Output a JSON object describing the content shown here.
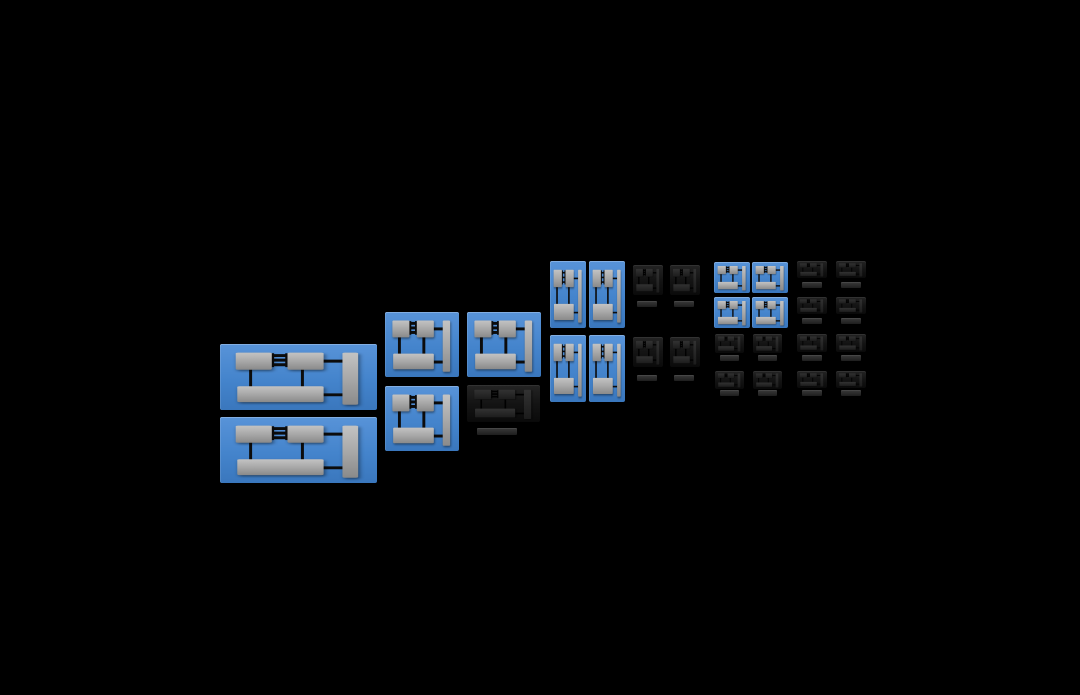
{
  "scene": {
    "width": 1080,
    "height": 695,
    "kind": "zoomable-canvas",
    "tile_icon": "block-diagram-icon",
    "tile_variants": [
      "blue",
      "dark"
    ]
  },
  "palette": {
    "background": "#000000",
    "tile_highlight_top": "#5893d8",
    "tile_highlight_mid": "#4484cc",
    "tile_highlight_bottom": "#3a77bd",
    "tile_faded_top": "#242424",
    "tile_faded_mid": "#141414",
    "tile_faded_bottom": "#0a0a0a",
    "block_gray_top": "#c3c3c3",
    "block_gray_mid": "#a8a8a8",
    "block_gray_bottom": "#8a8a8a",
    "block_dark_top": "#323232",
    "block_dark_bottom": "#1c1c1c",
    "wire_color": "#0c0c0c",
    "label_bar_top": "#3a3a3a",
    "label_bar_bottom": "#1e1e1e"
  },
  "tiles": [
    {
      "id": "large-1",
      "variant": "blue",
      "x": 220,
      "y": 344,
      "w": 157,
      "h": 66
    },
    {
      "id": "large-2",
      "variant": "blue",
      "x": 220,
      "y": 417,
      "w": 157,
      "h": 66
    },
    {
      "id": "medium-1",
      "variant": "blue",
      "x": 385,
      "y": 312,
      "w": 74,
      "h": 65
    },
    {
      "id": "medium-2",
      "variant": "blue",
      "x": 467,
      "y": 312,
      "w": 74,
      "h": 65
    },
    {
      "id": "medium-3",
      "variant": "blue",
      "x": 385,
      "y": 386,
      "w": 74,
      "h": 65
    },
    {
      "id": "medium-faded",
      "variant": "dark",
      "x": 467,
      "y": 385,
      "w": 73,
      "h": 37,
      "label_bar": {
        "x": 477,
        "y": 428,
        "w": 40,
        "h": 7
      }
    },
    {
      "id": "tall-1",
      "variant": "blue",
      "x": 550,
      "y": 261,
      "w": 36,
      "h": 67
    },
    {
      "id": "tall-2",
      "variant": "blue",
      "x": 589,
      "y": 261,
      "w": 36,
      "h": 67
    },
    {
      "id": "tall-3",
      "variant": "blue",
      "x": 550,
      "y": 335,
      "w": 36,
      "h": 67
    },
    {
      "id": "tall-4",
      "variant": "blue",
      "x": 589,
      "y": 335,
      "w": 36,
      "h": 67
    },
    {
      "id": "square-faded-1",
      "variant": "dark",
      "x": 633,
      "y": 265,
      "w": 30,
      "h": 30,
      "label_bar": {
        "x": 637,
        "y": 301,
        "w": 20,
        "h": 6
      }
    },
    {
      "id": "square-faded-2",
      "variant": "dark",
      "x": 670,
      "y": 265,
      "w": 30,
      "h": 30,
      "label_bar": {
        "x": 674,
        "y": 301,
        "w": 20,
        "h": 6
      }
    },
    {
      "id": "square-faded-3",
      "variant": "dark",
      "x": 633,
      "y": 337,
      "w": 30,
      "h": 30,
      "label_bar": {
        "x": 637,
        "y": 375,
        "w": 20,
        "h": 6
      }
    },
    {
      "id": "square-faded-4",
      "variant": "dark",
      "x": 670,
      "y": 337,
      "w": 30,
      "h": 30,
      "label_bar": {
        "x": 674,
        "y": 375,
        "w": 20,
        "h": 6
      }
    },
    {
      "id": "small-1",
      "variant": "blue",
      "x": 714,
      "y": 262,
      "w": 36,
      "h": 31
    },
    {
      "id": "small-2",
      "variant": "blue",
      "x": 752,
      "y": 262,
      "w": 36,
      "h": 31
    },
    {
      "id": "small-3",
      "variant": "blue",
      "x": 714,
      "y": 297,
      "w": 36,
      "h": 31
    },
    {
      "id": "small-4",
      "variant": "blue",
      "x": 752,
      "y": 297,
      "w": 36,
      "h": 31
    },
    {
      "id": "mini-faded-1",
      "variant": "dark",
      "x": 715,
      "y": 334,
      "w": 29,
      "h": 19,
      "label_bar": {
        "x": 720,
        "y": 355,
        "w": 19,
        "h": 6
      }
    },
    {
      "id": "mini-faded-2",
      "variant": "dark",
      "x": 753,
      "y": 334,
      "w": 29,
      "h": 19,
      "label_bar": {
        "x": 758,
        "y": 355,
        "w": 19,
        "h": 6
      }
    },
    {
      "id": "mini-faded-3",
      "variant": "dark",
      "x": 715,
      "y": 371,
      "w": 29,
      "h": 18,
      "label_bar": {
        "x": 720,
        "y": 390,
        "w": 19,
        "h": 6
      }
    },
    {
      "id": "mini-faded-4",
      "variant": "dark",
      "x": 753,
      "y": 371,
      "w": 29,
      "h": 18,
      "label_bar": {
        "x": 758,
        "y": 390,
        "w": 19,
        "h": 6
      }
    },
    {
      "id": "mini-faded-5",
      "variant": "dark",
      "x": 797,
      "y": 261,
      "w": 30,
      "h": 17,
      "label_bar": {
        "x": 802,
        "y": 282,
        "w": 20,
        "h": 6
      }
    },
    {
      "id": "mini-faded-6",
      "variant": "dark",
      "x": 836,
      "y": 261,
      "w": 30,
      "h": 17,
      "label_bar": {
        "x": 841,
        "y": 282,
        "w": 20,
        "h": 6
      }
    },
    {
      "id": "mini-faded-7",
      "variant": "dark",
      "x": 797,
      "y": 297,
      "w": 30,
      "h": 17,
      "label_bar": {
        "x": 802,
        "y": 318,
        "w": 20,
        "h": 6
      }
    },
    {
      "id": "mini-faded-8",
      "variant": "dark",
      "x": 836,
      "y": 297,
      "w": 30,
      "h": 17,
      "label_bar": {
        "x": 841,
        "y": 318,
        "w": 20,
        "h": 6
      }
    },
    {
      "id": "mini-faded-9",
      "variant": "dark",
      "x": 797,
      "y": 334,
      "w": 30,
      "h": 18,
      "label_bar": {
        "x": 802,
        "y": 355,
        "w": 20,
        "h": 6
      }
    },
    {
      "id": "mini-faded-10",
      "variant": "dark",
      "x": 836,
      "y": 334,
      "w": 30,
      "h": 18,
      "label_bar": {
        "x": 841,
        "y": 355,
        "w": 20,
        "h": 6
      }
    },
    {
      "id": "mini-faded-11",
      "variant": "dark",
      "x": 797,
      "y": 371,
      "w": 30,
      "h": 17,
      "label_bar": {
        "x": 802,
        "y": 390,
        "w": 20,
        "h": 6
      }
    },
    {
      "id": "mini-faded-12",
      "variant": "dark",
      "x": 836,
      "y": 371,
      "w": 30,
      "h": 17,
      "label_bar": {
        "x": 841,
        "y": 390,
        "w": 20,
        "h": 6
      }
    }
  ]
}
